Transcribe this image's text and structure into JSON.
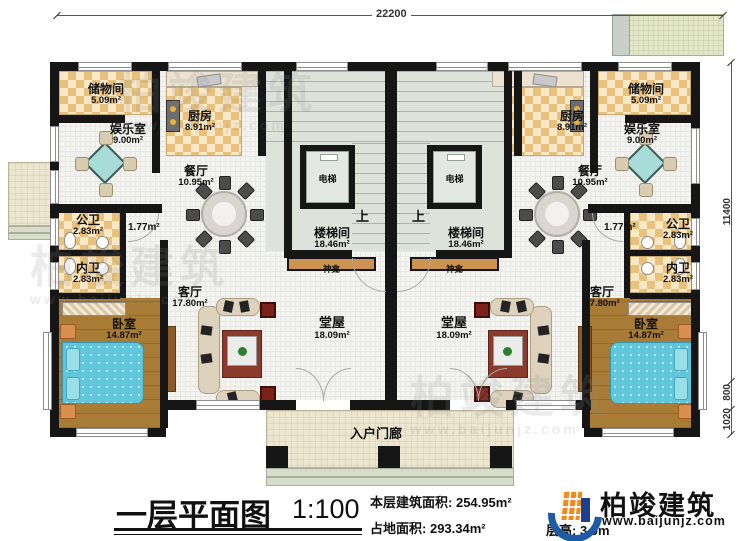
{
  "rooms": {
    "storage": {
      "name": "储物间",
      "area": "5.09m²"
    },
    "kitchen": {
      "name": "厨房",
      "area": "8.91m²"
    },
    "entertainment": {
      "name": "娱乐室",
      "area": "9.00m²"
    },
    "dining": {
      "name": "餐厅",
      "area": "10.95m²"
    },
    "public_bath": {
      "name": "公卫",
      "area": "2.83m²"
    },
    "private_bath": {
      "name": "内卫",
      "area": "2.83m²"
    },
    "bedroom": {
      "name": "卧室",
      "area": "14.87m²"
    },
    "living": {
      "name": "客厅",
      "area": "17.80m²"
    },
    "hall": {
      "name": "堂屋",
      "area": "18.09m²"
    },
    "stairwell": {
      "name": "楼梯间",
      "area": "18.46m²"
    },
    "corridor": {
      "area": "1.77m²"
    }
  },
  "labels": {
    "elevator": "电梯",
    "up": "上",
    "shrine": "神龛",
    "porch": "入户门廊"
  },
  "dimensions": {
    "top_width": "22200",
    "right_height": "11400",
    "right_800": "800",
    "right_1020": "1020"
  },
  "titleblock": {
    "title": "一层平面图",
    "scale": "1:100",
    "stats": [
      {
        "label": "本层建筑面积:",
        "value": "254.95m²"
      },
      {
        "label": "占地面积:",
        "value": "293.34m²"
      },
      {
        "label": "层高:",
        "value": "3.9m"
      }
    ]
  },
  "logo": {
    "name": "柏竣建筑",
    "site": "www.baijunjz.com"
  },
  "watermark": {
    "text": "柏竣建筑",
    "site": "www.baijunjz.com"
  }
}
